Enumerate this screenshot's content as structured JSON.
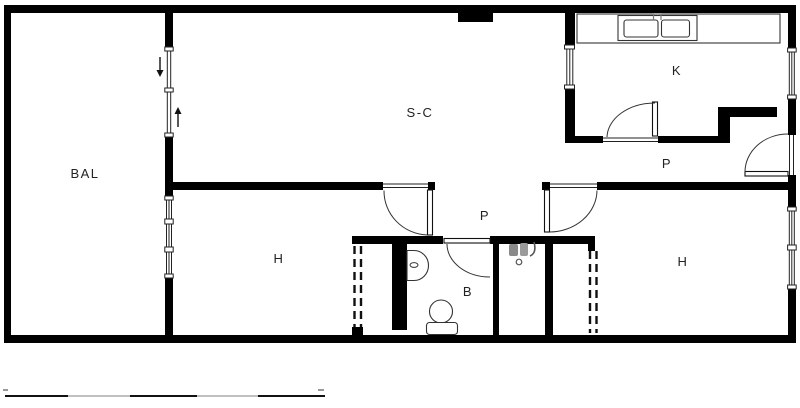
{
  "plan": {
    "type": "apartment-floor-plan",
    "rooms": [
      {
        "id": "balcony",
        "label": "BAL"
      },
      {
        "id": "living-room",
        "label": "S-C"
      },
      {
        "id": "kitchen",
        "label": "K"
      },
      {
        "id": "hall-upper",
        "label": "P"
      },
      {
        "id": "hall-lower",
        "label": "P"
      },
      {
        "id": "bedroom-left",
        "label": "H"
      },
      {
        "id": "bedroom-right",
        "label": "H"
      },
      {
        "id": "bathroom",
        "label": "B"
      }
    ],
    "fixtures": [
      "kitchen-counter",
      "kitchen-double-sink",
      "bath-washbasin",
      "toilet",
      "wc-fixture",
      "wardrobe-left",
      "wardrobe-right",
      "chimney-block"
    ],
    "doors": [
      "balcony-sliding-door",
      "bedroom-left-door",
      "bedroom-right-door",
      "bathroom-door",
      "kitchen-door",
      "entry-door"
    ],
    "windows": [
      "balcony-window",
      "kitchen-west-window",
      "kitchen-east-window",
      "bedroom-right-window"
    ],
    "colors": {
      "wall": "#000000",
      "line": "#222222",
      "label": "#222222",
      "scale_dark": "#111111",
      "scale_light": "#c0c0c0"
    }
  }
}
